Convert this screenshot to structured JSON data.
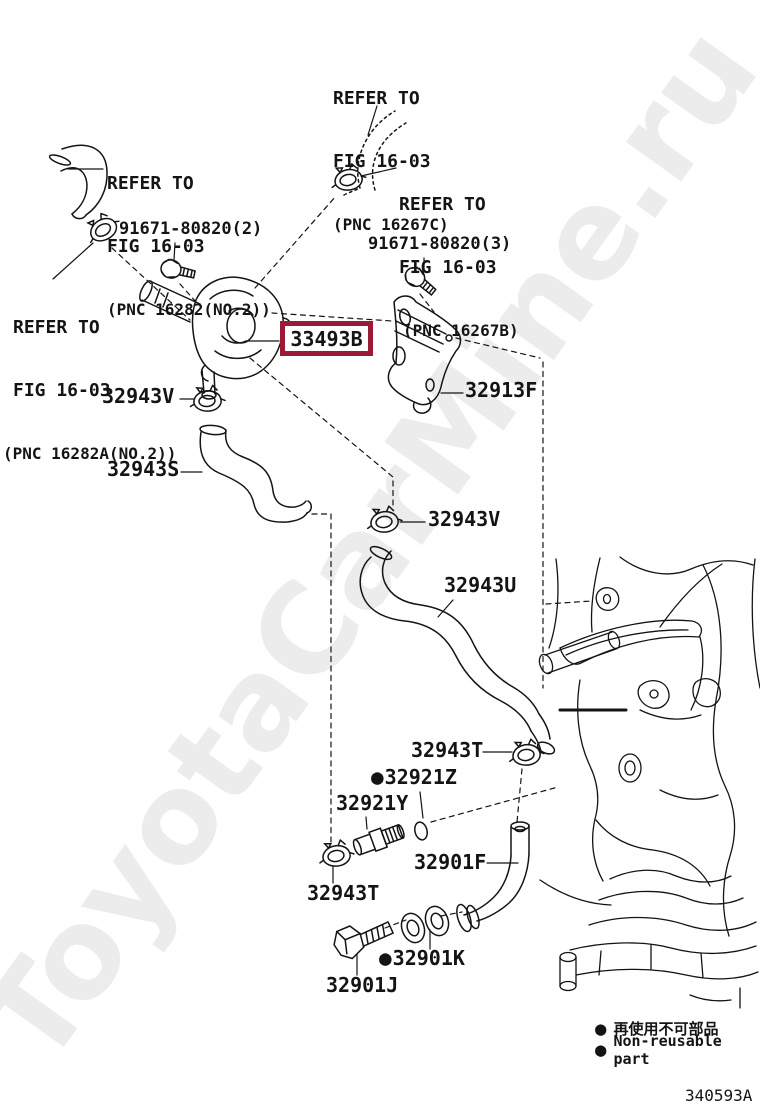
{
  "colors": {
    "line": "#141414",
    "highlight_box": "#9b1a38",
    "watermark": "#ececec"
  },
  "watermark": "ToyotaCarMine.ru",
  "drawing_code": "340593A",
  "bullet": "●",
  "notes": {
    "n16267c": {
      "line1": "REFER TO",
      "line2": "FIG 16-03",
      "line3": "(PNC 16267C)"
    },
    "n16282": {
      "line1": "REFER TO",
      "line2": "FIG 16-03",
      "line3": "(PNC 16282(NO.2))"
    },
    "n16267b": {
      "line1": "REFER TO",
      "line2": "FIG 16-03",
      "line3": "(PNC 16267B)"
    },
    "n16282a": {
      "line1": "REFER TO",
      "line2": "FIG 16-03",
      "line3": "(PNC 16282A(NO.2))"
    }
  },
  "parts": {
    "bolt2": "91671-80820(2)",
    "bolt3": "91671-80820(3)",
    "cooler": "33493B",
    "bracket": "32913F",
    "clampV1": "32943V",
    "hoseS": "32943S",
    "clampV2": "32943V",
    "hoseU": "32943U",
    "clampT_right": "32943T",
    "oring": "32921Z",
    "union": "32921Y",
    "clampT_left": "32943T",
    "hoseF": "32901F",
    "boltJ": "32901J",
    "gasketK": "32901K"
  },
  "legend": {
    "ja": "再使用不可部品",
    "en": "Non-reusable part"
  }
}
